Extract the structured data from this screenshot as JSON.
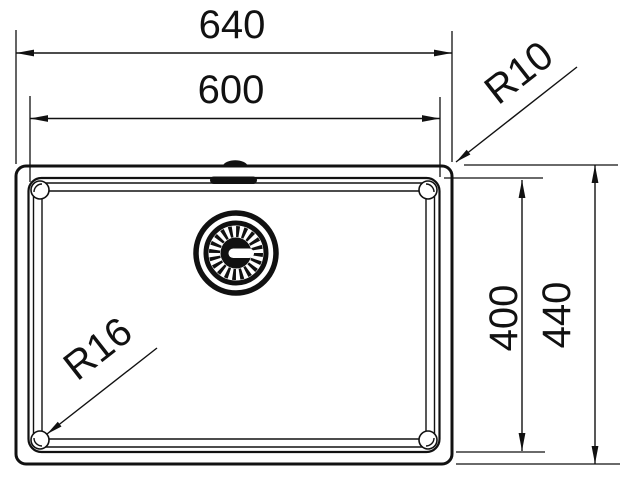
{
  "drawing": {
    "type": "technical dimension drawing",
    "subject": "kitchen sink bowl - top view",
    "background_color": "#ffffff",
    "line_color": "#111111",
    "dimensions": {
      "overall_width": "640",
      "bowl_width": "600",
      "bowl_depth": "400",
      "overall_depth": "440",
      "outer_corner_radius": "R10",
      "bowl_corner_radius": "R16"
    }
  }
}
